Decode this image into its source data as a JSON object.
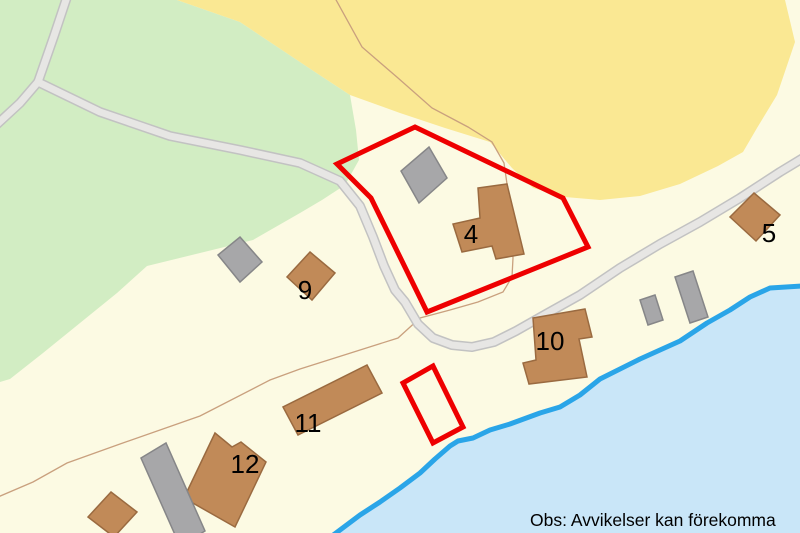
{
  "map": {
    "disclaimer": "Obs: Avvikelser kan förekomma",
    "building_labels": {
      "b4": "4",
      "b5": "5",
      "b9": "9",
      "b10": "10",
      "b11": "11",
      "b12": "12"
    },
    "colors": {
      "land": "#FCFAE3",
      "field_yellow": "#FAE893",
      "forest_green": "#D2EDC3",
      "road_fill": "#E7E6E4",
      "road_casing": "#C2C2C2",
      "water": "#C9E6F8",
      "water_edge": "#2AA5E8",
      "parcel_highlight_red": "#EE0000",
      "building_brown": "#C18A58",
      "building_brown_border": "#9A6A40",
      "building_gray": "#A7A7A9",
      "building_gray_border": "#868688",
      "boundary_line_tan": "#C9A07E",
      "label_black": "#000000"
    }
  }
}
